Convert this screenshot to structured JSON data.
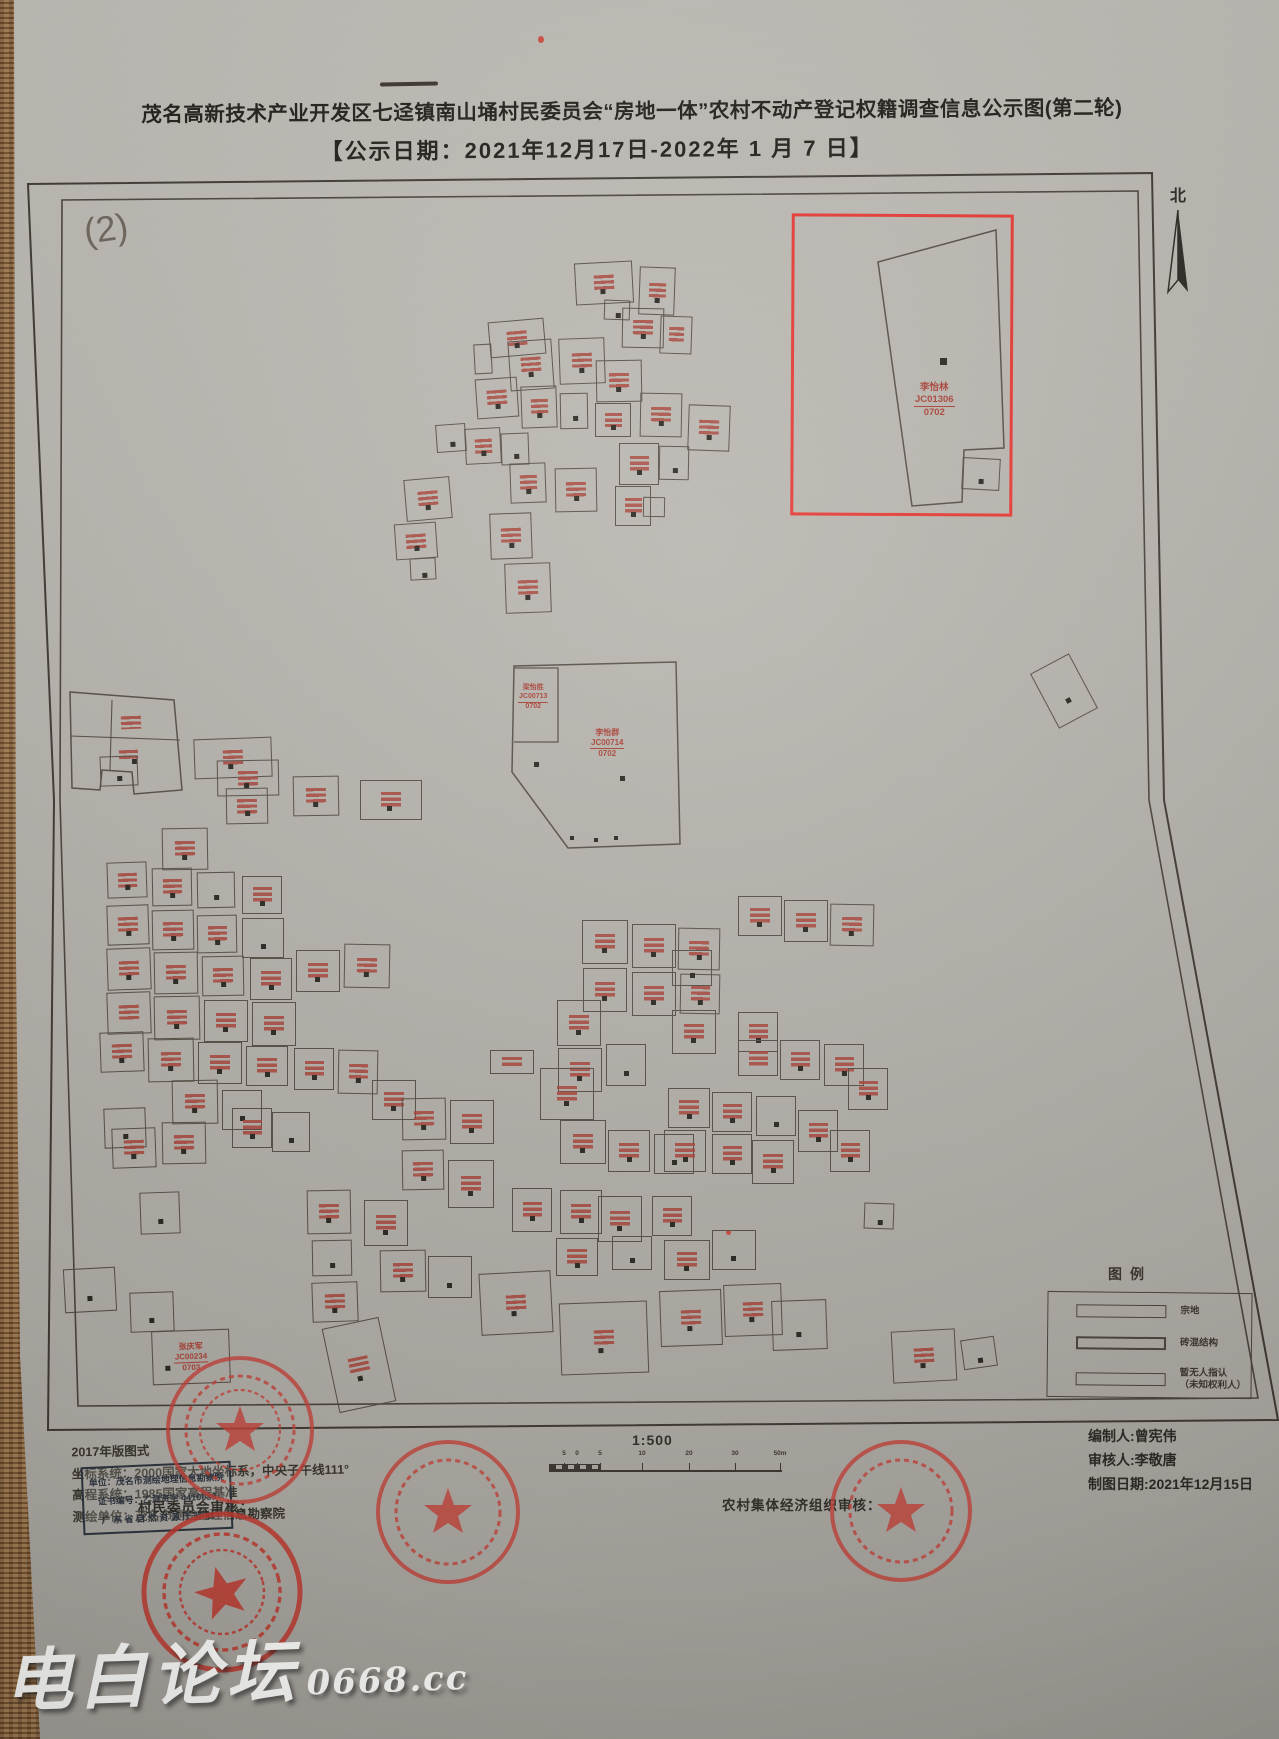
{
  "title": {
    "line1": "茂名高新技术产业开发区七迳镇南山埇村民委员会“房地一体”农村不动产登记权籍调查信息公示图(第二轮)",
    "line2": "【公示日期：2021年12月17日-2022年 1 月 7 日】"
  },
  "sheet_number": "(2)",
  "north_label": "北",
  "highlight_parcel": {
    "name": "李怡林",
    "code": "JC01306",
    "area": "0702"
  },
  "central_parcel": {
    "name": "李怡群",
    "code": "JC00714",
    "area": "0702"
  },
  "central_sub_parcel": {
    "name": "梁怡胜",
    "code": "JC00713",
    "area": "0702"
  },
  "bottom_parcel": {
    "name": "张庆军",
    "code": "JC00234",
    "area": "0703"
  },
  "legend": {
    "title": "图例",
    "items": [
      {
        "label": "宗地"
      },
      {
        "label": "砖混结构"
      },
      {
        "label": "暂无人指认"
      },
      {
        "label": "（未知权利人）"
      }
    ]
  },
  "map_notes": {
    "line1": "2017年版图式",
    "line2": "坐标系统：2000国家大地坐标系，中央子午线111°",
    "line3": "高程系统：1985国家高程基准",
    "line4": "测绘单位：茂名市测绘地理信息勘察院"
  },
  "cert_stamp": {
    "line1": "单位：茂名市测绘地理信息勘察院",
    "line2": "证书编号：乙测资字 4410039",
    "line3": "广 东 省 自 然 资 源 厅 监 制"
  },
  "review": {
    "village": "村民委员会审核：",
    "collective": "农村集体经济组织审核："
  },
  "scale": {
    "ratio": "1:500",
    "ticks": [
      {
        "x": 15,
        "label": "5"
      },
      {
        "x": 28,
        "label": "0"
      },
      {
        "x": 51,
        "label": "5"
      },
      {
        "x": 93,
        "label": "10"
      },
      {
        "x": 140,
        "label": "20"
      },
      {
        "x": 186,
        "label": "30"
      },
      {
        "x": 231,
        "label": "50m"
      }
    ]
  },
  "credits": {
    "compiler": "编制人:曾宪伟",
    "reviewer": "审核人:李敬唐",
    "date": "制图日期:2021年12月15日"
  },
  "watermark": {
    "text": "电白论坛",
    "site": "0668.cc"
  },
  "colors": {
    "paper": "#b6b2ac",
    "ink": "#2e2a25",
    "parcel_line": "#554e46",
    "label_red": "#a84237",
    "highlight_red": "#e63832",
    "stamp_red": "#c4433a"
  },
  "parcels": [
    [
      563,
      262,
      58,
      42,
      -3,
      3
    ],
    [
      627,
      267,
      36,
      48,
      2,
      3
    ],
    [
      592,
      300,
      26,
      20,
      2,
      2
    ],
    [
      477,
      320,
      56,
      36,
      -5,
      3
    ],
    [
      462,
      344,
      18,
      30,
      -3,
      0
    ],
    [
      497,
      340,
      44,
      50,
      -4,
      3
    ],
    [
      547,
      338,
      46,
      46,
      -2,
      3
    ],
    [
      610,
      308,
      42,
      40,
      1,
      3
    ],
    [
      648,
      316,
      32,
      38,
      2,
      1
    ],
    [
      584,
      360,
      46,
      42,
      -1,
      3
    ],
    [
      464,
      378,
      42,
      40,
      -4,
      3
    ],
    [
      509,
      386,
      36,
      42,
      -2,
      3
    ],
    [
      548,
      393,
      28,
      36,
      -1,
      2
    ],
    [
      628,
      393,
      42,
      44,
      1,
      3
    ],
    [
      583,
      403,
      36,
      34,
      0,
      3
    ],
    [
      676,
      405,
      42,
      46,
      2,
      3
    ],
    [
      424,
      424,
      30,
      28,
      -4,
      2
    ],
    [
      453,
      428,
      36,
      36,
      -3,
      3
    ],
    [
      489,
      433,
      28,
      32,
      -2,
      2
    ],
    [
      607,
      443,
      40,
      42,
      0,
      3
    ],
    [
      647,
      446,
      30,
      34,
      1,
      2
    ],
    [
      498,
      463,
      36,
      40,
      -2,
      3
    ],
    [
      543,
      468,
      42,
      44,
      -1,
      3
    ],
    [
      393,
      478,
      46,
      42,
      -5,
      3
    ],
    [
      603,
      486,
      36,
      40,
      0,
      3
    ],
    [
      631,
      497,
      22,
      20,
      1,
      0
    ],
    [
      478,
      513,
      42,
      46,
      -2,
      3
    ],
    [
      383,
      523,
      42,
      36,
      -4,
      3
    ],
    [
      398,
      558,
      26,
      22,
      -3,
      2
    ],
    [
      493,
      563,
      46,
      50,
      -2,
      3
    ],
    [
      950,
      458,
      38,
      32,
      3,
      2
    ],
    [
      1030,
      660,
      44,
      62,
      -28,
      2
    ],
    [
      98,
      706,
      42,
      32,
      -2,
      5
    ],
    [
      96,
      742,
      40,
      26,
      -2,
      5
    ],
    [
      112,
      748,
      20,
      18,
      0,
      6
    ],
    [
      88,
      756,
      38,
      30,
      -2,
      2
    ],
    [
      182,
      738,
      78,
      40,
      -2,
      3
    ],
    [
      205,
      760,
      62,
      36,
      -1,
      3
    ],
    [
      281,
      776,
      46,
      40,
      -1,
      3
    ],
    [
      348,
      780,
      62,
      40,
      0,
      3
    ],
    [
      214,
      788,
      42,
      36,
      -1,
      3
    ],
    [
      150,
      828,
      46,
      42,
      -1,
      3
    ],
    [
      95,
      862,
      40,
      36,
      -2,
      3
    ],
    [
      140,
      868,
      40,
      38,
      -1,
      3
    ],
    [
      185,
      872,
      38,
      36,
      -1,
      2
    ],
    [
      230,
      876,
      40,
      38,
      0,
      3
    ],
    [
      95,
      905,
      42,
      40,
      -2,
      3
    ],
    [
      140,
      910,
      42,
      40,
      -1,
      3
    ],
    [
      185,
      915,
      40,
      38,
      -1,
      3
    ],
    [
      230,
      918,
      42,
      40,
      0,
      2
    ],
    [
      95,
      948,
      44,
      42,
      -2,
      3
    ],
    [
      142,
      952,
      44,
      42,
      -1,
      3
    ],
    [
      190,
      956,
      42,
      40,
      -1,
      3
    ],
    [
      238,
      958,
      42,
      42,
      0,
      3
    ],
    [
      284,
      950,
      44,
      42,
      0,
      3
    ],
    [
      332,
      944,
      46,
      44,
      1,
      3
    ],
    [
      95,
      992,
      44,
      42,
      -2,
      1
    ],
    [
      142,
      996,
      46,
      44,
      -1,
      3
    ],
    [
      192,
      1000,
      44,
      42,
      0,
      3
    ],
    [
      240,
      1002,
      44,
      44,
      0,
      3
    ],
    [
      88,
      1032,
      44,
      40,
      -2,
      3
    ],
    [
      136,
      1038,
      46,
      44,
      -1,
      3
    ],
    [
      186,
      1042,
      44,
      42,
      0,
      3
    ],
    [
      234,
      1046,
      42,
      40,
      0,
      3
    ],
    [
      282,
      1048,
      40,
      42,
      0,
      3
    ],
    [
      326,
      1050,
      40,
      44,
      1,
      3
    ],
    [
      160,
      1080,
      46,
      44,
      -1,
      3
    ],
    [
      210,
      1090,
      40,
      40,
      0,
      2
    ],
    [
      92,
      1108,
      42,
      40,
      -2,
      2
    ],
    [
      100,
      1128,
      44,
      40,
      -2,
      3
    ],
    [
      150,
      1122,
      44,
      42,
      -1,
      3
    ],
    [
      220,
      1108,
      40,
      40,
      0,
      3
    ],
    [
      260,
      1112,
      38,
      40,
      0,
      2
    ],
    [
      128,
      1192,
      40,
      42,
      -2,
      2
    ],
    [
      295,
      1190,
      44,
      44,
      -1,
      3
    ],
    [
      352,
      1200,
      44,
      46,
      0,
      3
    ],
    [
      300,
      1240,
      40,
      36,
      -1,
      2
    ],
    [
      360,
      1080,
      44,
      40,
      0,
      3
    ],
    [
      570,
      920,
      46,
      44,
      0,
      3
    ],
    [
      620,
      924,
      44,
      44,
      0,
      3
    ],
    [
      666,
      928,
      42,
      42,
      1,
      3
    ],
    [
      571,
      968,
      44,
      44,
      0,
      3
    ],
    [
      620,
      972,
      44,
      44,
      0,
      3
    ],
    [
      668,
      974,
      40,
      40,
      1,
      3
    ],
    [
      545,
      1000,
      44,
      46,
      0,
      3
    ],
    [
      546,
      1048,
      44,
      44,
      0,
      3
    ],
    [
      594,
      1044,
      40,
      42,
      0,
      2
    ],
    [
      478,
      1050,
      44,
      24,
      0,
      1
    ],
    [
      528,
      1068,
      54,
      52,
      0,
      3
    ],
    [
      390,
      1098,
      44,
      42,
      -1,
      3
    ],
    [
      438,
      1100,
      44,
      44,
      0,
      3
    ],
    [
      548,
      1120,
      46,
      44,
      0,
      3
    ],
    [
      596,
      1130,
      42,
      42,
      0,
      3
    ],
    [
      642,
      1134,
      40,
      40,
      0,
      2
    ],
    [
      390,
      1150,
      42,
      40,
      -1,
      3
    ],
    [
      436,
      1160,
      46,
      48,
      0,
      3
    ],
    [
      500,
      1188,
      40,
      44,
      0,
      3
    ],
    [
      548,
      1190,
      42,
      44,
      0,
      3
    ],
    [
      586,
      1196,
      44,
      46,
      0,
      3
    ],
    [
      640,
      1196,
      40,
      40,
      0,
      3
    ],
    [
      600,
      1236,
      40,
      34,
      0,
      2
    ],
    [
      544,
      1238,
      42,
      38,
      0,
      3
    ],
    [
      652,
      1240,
      46,
      40,
      0,
      3
    ],
    [
      700,
      1230,
      44,
      40,
      0,
      2
    ],
    [
      726,
      896,
      44,
      40,
      0,
      3
    ],
    [
      772,
      900,
      44,
      42,
      0,
      3
    ],
    [
      818,
      904,
      44,
      42,
      1,
      3
    ],
    [
      660,
      950,
      40,
      36,
      0,
      2
    ],
    [
      660,
      1010,
      44,
      44,
      0,
      3
    ],
    [
      726,
      1012,
      40,
      40,
      0,
      3
    ],
    [
      726,
      1040,
      40,
      36,
      0,
      1
    ],
    [
      768,
      1040,
      40,
      40,
      0,
      3
    ],
    [
      812,
      1044,
      40,
      42,
      0,
      3
    ],
    [
      836,
      1068,
      40,
      42,
      0,
      3
    ],
    [
      656,
      1088,
      42,
      40,
      0,
      3
    ],
    [
      700,
      1092,
      40,
      40,
      0,
      3
    ],
    [
      744,
      1096,
      40,
      40,
      0,
      2
    ],
    [
      786,
      1110,
      40,
      42,
      0,
      3
    ],
    [
      818,
      1130,
      40,
      42,
      0,
      3
    ],
    [
      652,
      1130,
      42,
      42,
      0,
      3
    ],
    [
      700,
      1134,
      40,
      40,
      0,
      3
    ],
    [
      740,
      1140,
      42,
      44,
      0,
      3
    ],
    [
      852,
      1203,
      30,
      26,
      2,
      2
    ],
    [
      950,
      1338,
      34,
      30,
      -8,
      2
    ],
    [
      52,
      1268,
      52,
      44,
      -3,
      2
    ],
    [
      118,
      1292,
      44,
      40,
      -2,
      2
    ],
    [
      300,
      1282,
      46,
      40,
      -2,
      3
    ],
    [
      368,
      1250,
      46,
      42,
      -1,
      3
    ],
    [
      416,
      1256,
      44,
      42,
      0,
      2
    ],
    [
      468,
      1272,
      72,
      62,
      -3,
      3
    ],
    [
      548,
      1302,
      88,
      72,
      -2,
      3
    ],
    [
      648,
      1290,
      62,
      56,
      -2,
      3
    ],
    [
      712,
      1284,
      58,
      52,
      -2,
      3
    ],
    [
      760,
      1300,
      55,
      50,
      -2,
      2
    ],
    [
      880,
      1330,
      64,
      52,
      -3,
      3
    ],
    [
      318,
      1322,
      58,
      86,
      -12,
      3
    ]
  ]
}
